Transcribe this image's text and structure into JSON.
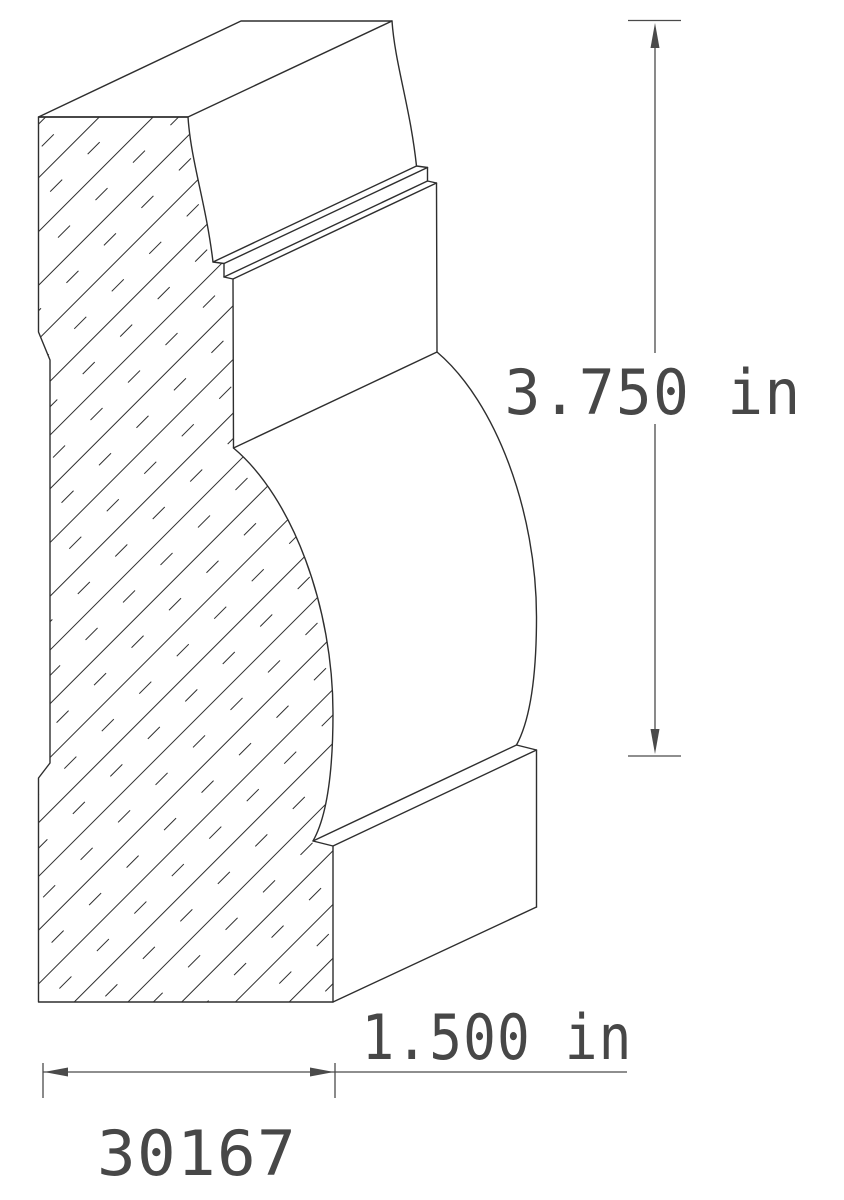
{
  "diagram": {
    "type": "cad-molding-profile-drawing",
    "part_number": "30167",
    "dimensions": {
      "height": {
        "label": "3.750 in",
        "value": 3.75,
        "unit": "in",
        "orientation": "vertical"
      },
      "width": {
        "label": "1.500 in",
        "value": 1.5,
        "unit": "in",
        "orientation": "horizontal"
      }
    },
    "colors": {
      "background": "#ffffff",
      "line": "#2e2e2e",
      "dimension_line": "#4a4a4a",
      "text": "#474747"
    }
  }
}
